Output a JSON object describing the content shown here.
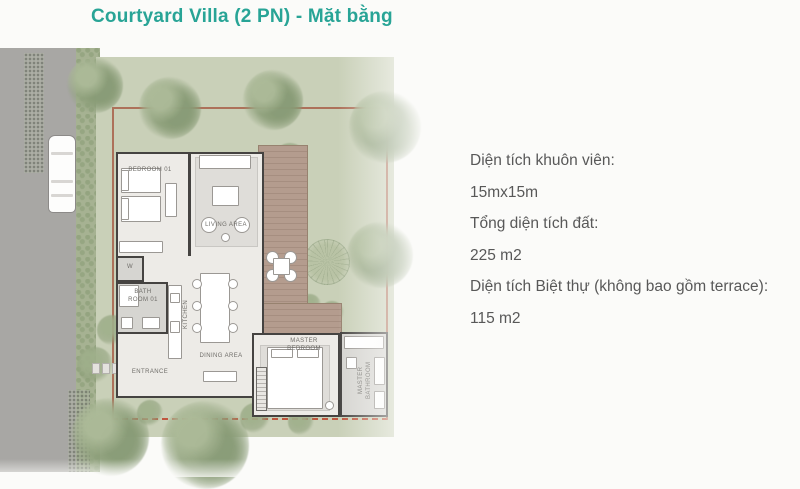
{
  "title": "Courtyard Villa (2 PN) - Mặt bằng",
  "info": {
    "lines": [
      {
        "text": "Diện tích khuôn viên:"
      },
      {
        "text": "15mx15m"
      },
      {
        "text": "Tổng diện tích đất:"
      },
      {
        "text": "225 m2"
      },
      {
        "text": "Diện tích Biệt thự (không bao gồm terrace):"
      },
      {
        "text": "115 m2"
      }
    ]
  },
  "plan": {
    "rooms": {
      "bedroom01": "BEDROOM 01",
      "living": "LIVING AREA",
      "kitchen": "KITCHEN",
      "dining": "DINING AREA",
      "bathroom01": "BATH ROOM 01",
      "entrance": "ENTRANCE",
      "master_bedroom": "MASTER BEDROOM",
      "master_bathroom": "MASTER BATHROOM",
      "wardrobe": "W"
    },
    "colors": {
      "accent_title": "#28a496",
      "body_text": "#585858",
      "site_green": "#c9d0b8",
      "deck_wood": "#b49c8e",
      "road_gray": "#a8a7a4",
      "wall": "#454341",
      "boundary_line": "#a65a43",
      "boundary_dashed": "#c04b34"
    }
  }
}
